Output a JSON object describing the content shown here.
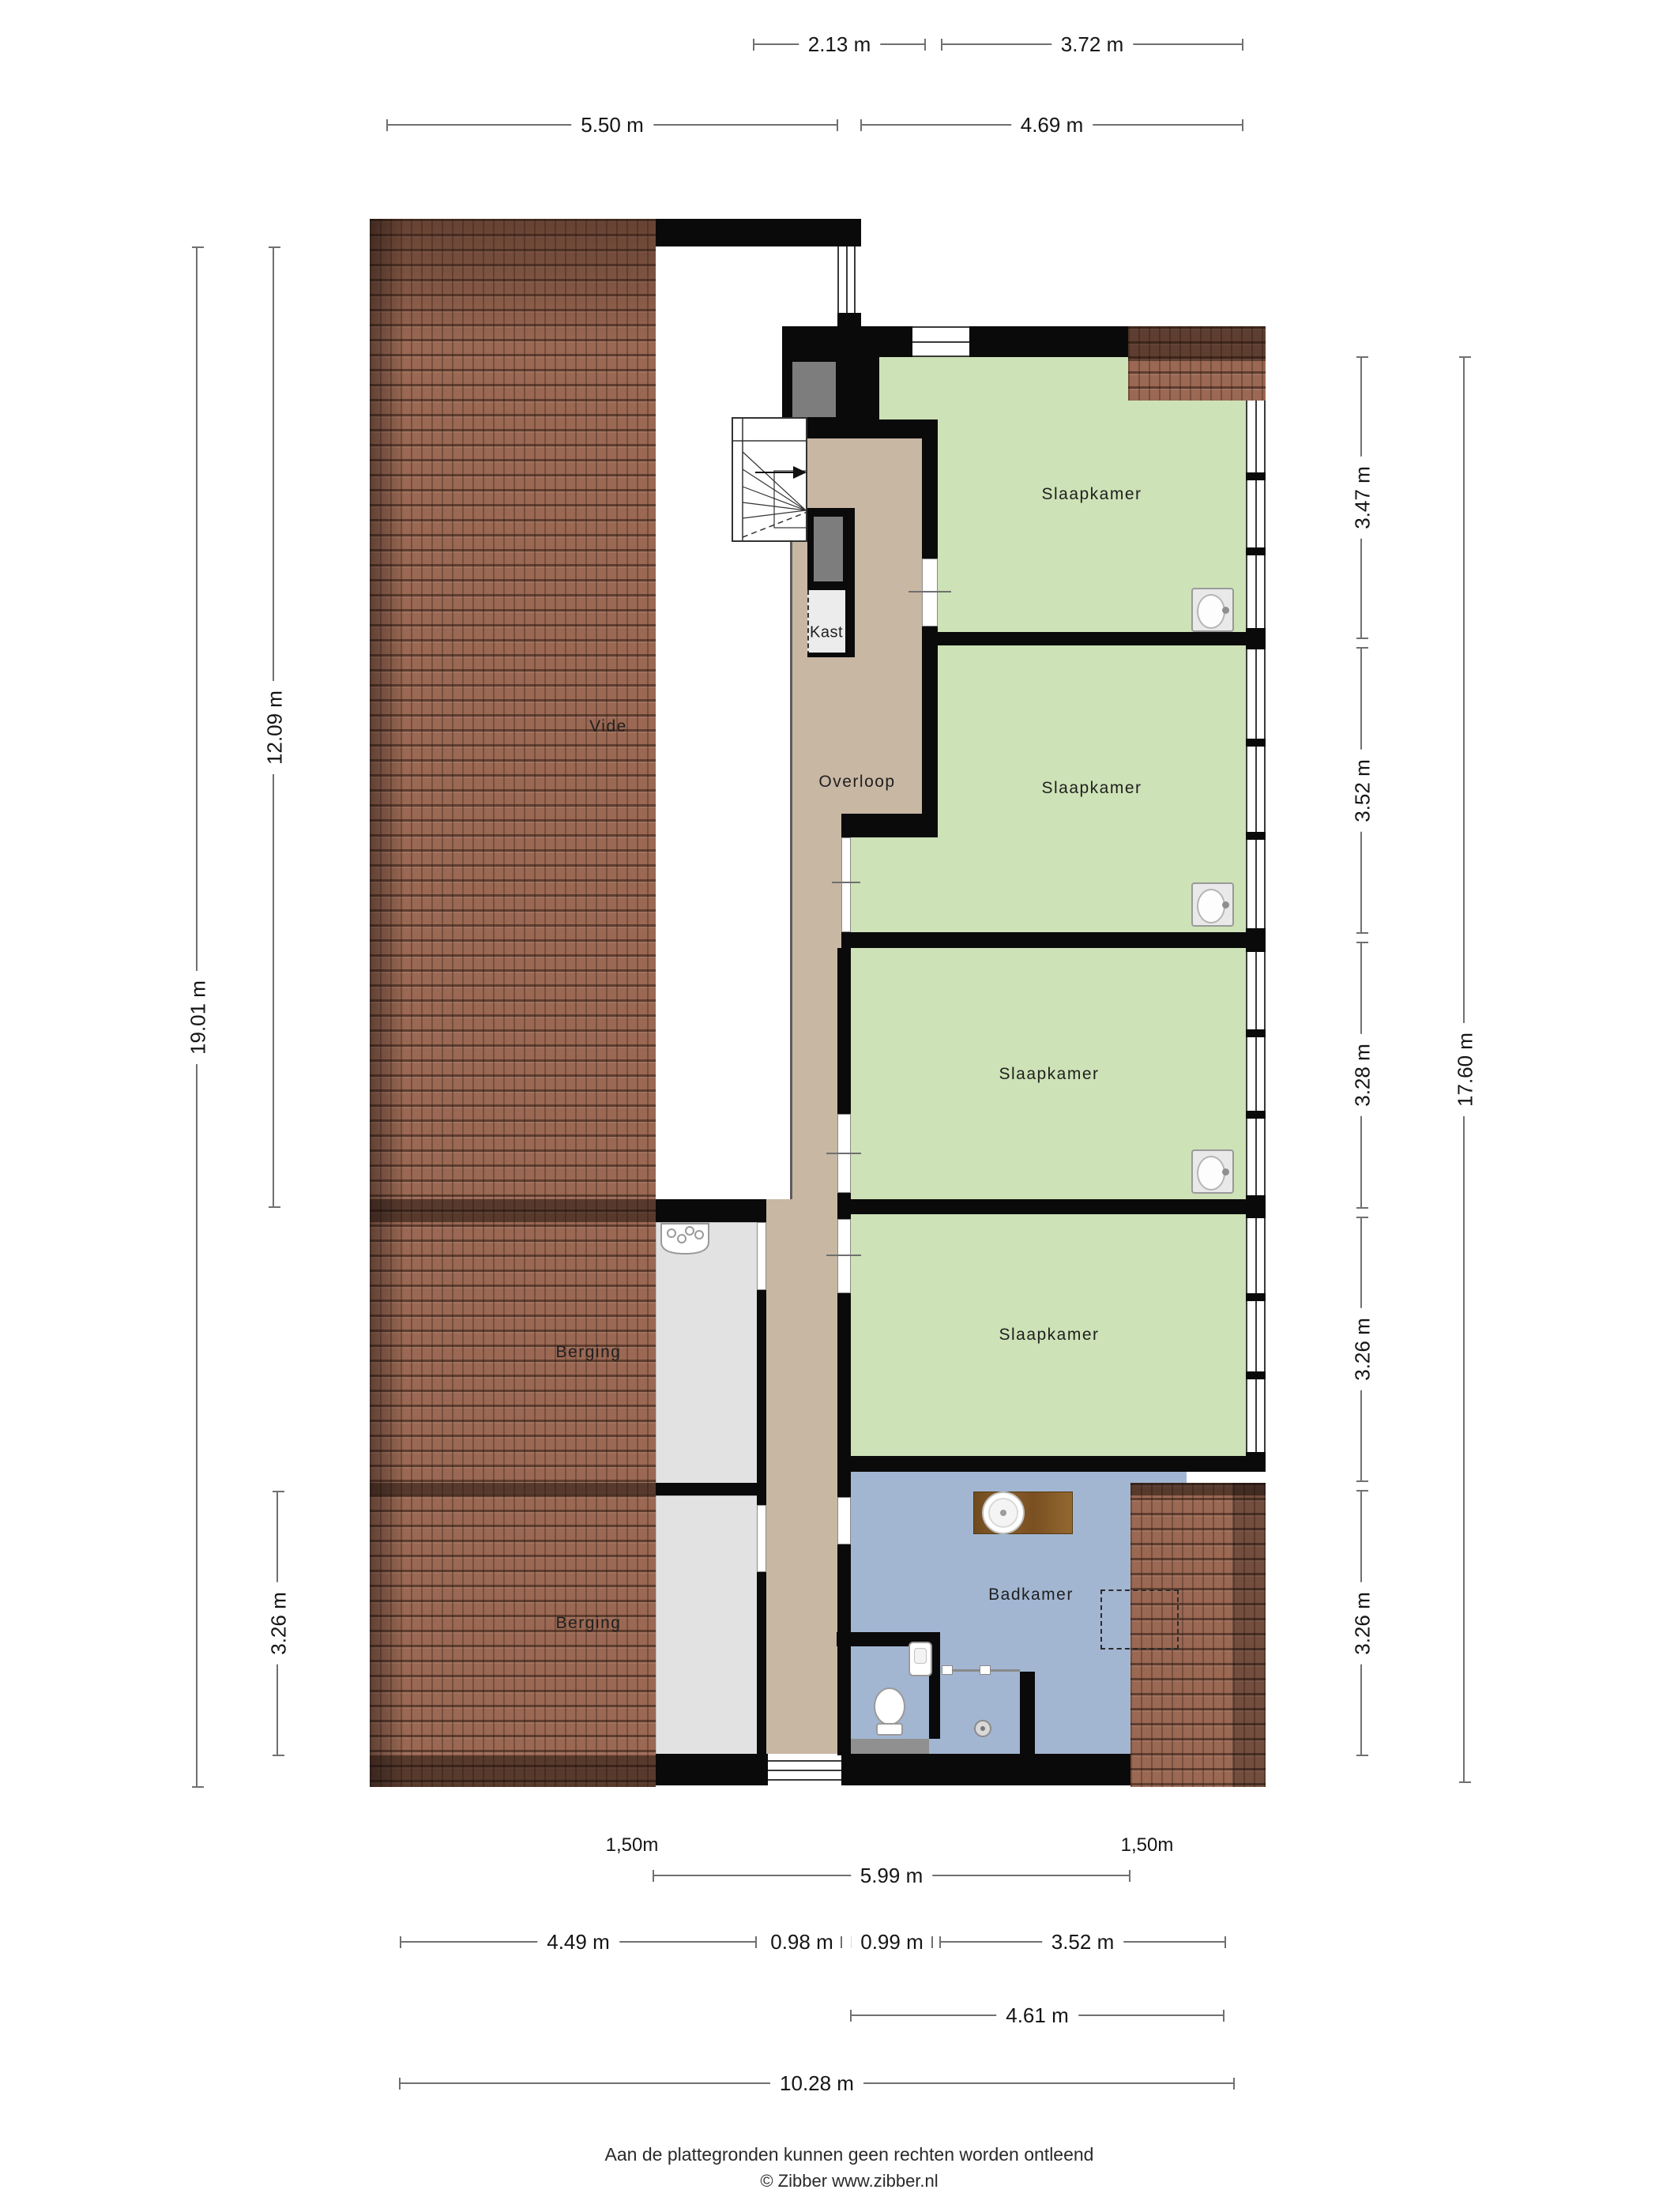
{
  "rooms": {
    "vide": "Vide",
    "overloop": "Overloop",
    "kast": "Kast",
    "slaapkamer": "Slaapkamer",
    "badkamer": "Badkamer",
    "berging": "Berging"
  },
  "dimensions": {
    "top_row_1": [
      "2.13 m",
      "3.72 m"
    ],
    "top_row_2": [
      "5.50 m",
      "4.69 m"
    ],
    "left": [
      "19.01 m",
      "12.09 m",
      "3.26 m"
    ],
    "right": [
      "3.47 m",
      "3.52 m",
      "3.28 m",
      "3.26 m",
      "3.26 m",
      "17.60 m"
    ],
    "bottom": [
      "1,50m",
      "1,50m",
      "5.99 m",
      "4.49 m",
      "0.98 m",
      "0.99 m",
      "3.52 m",
      "4.61 m",
      "10.28 m"
    ]
  },
  "footer": {
    "disclaimer": "Aan de plattegronden kunnen geen rechten worden ontleend",
    "copyright": "© Zibber www.zibber.nl"
  },
  "colors": {
    "roof_tile": "#9a6853",
    "bedroom_floor": "#cde2b6",
    "hallway_floor": "#c8b7a3",
    "bathroom_floor": "#a2b6d2",
    "storage_floor": "#e2e2e2",
    "wall": "#0a0a0a",
    "dimension_line": "#707070"
  }
}
